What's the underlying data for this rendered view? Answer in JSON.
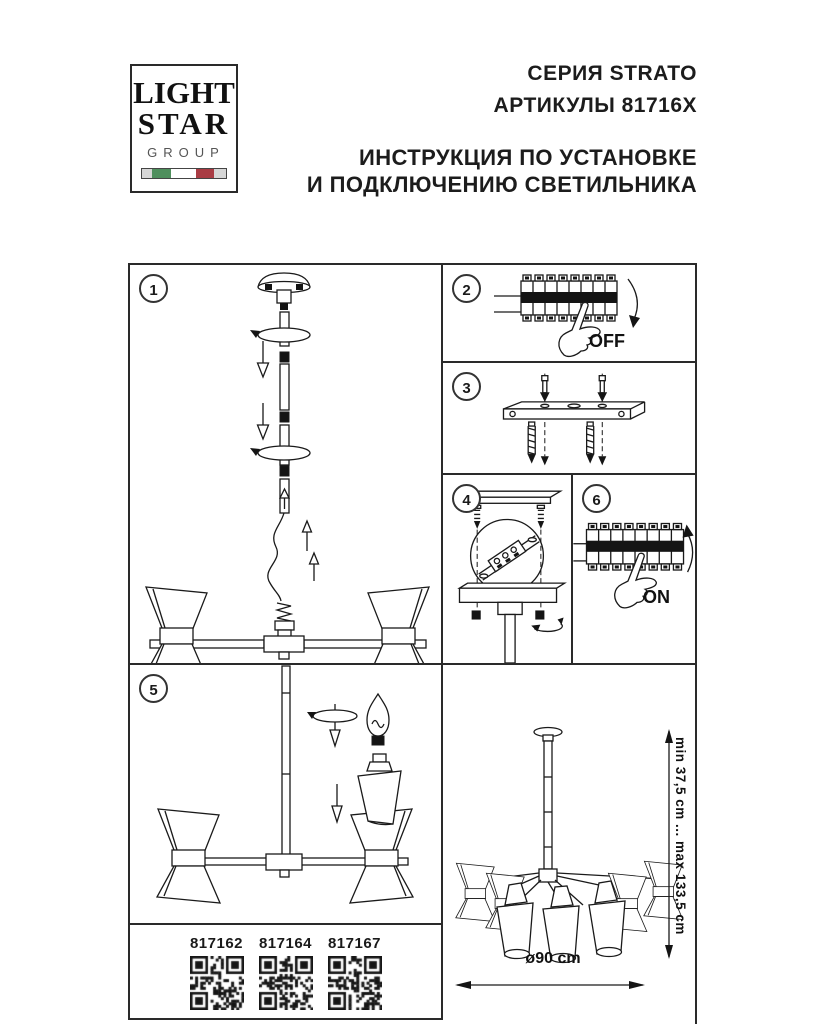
{
  "header": {
    "logo": {
      "line1": "LIGHT",
      "line2": "STAR",
      "line3": "GROUP",
      "flag_colors": [
        "#4f8f5d",
        "#ffffff",
        "#a93c44"
      ]
    },
    "series": "СЕРИЯ STRATO",
    "articles": "АРТИКУЛЫ 81716X",
    "instruction_line1": "ИНСТРУКЦИЯ ПО УСТАНОВКЕ",
    "instruction_line2": "И ПОДКЛЮЧЕНИЮ СВЕТИЛЬНИКА"
  },
  "panels": {
    "step1": {
      "number": "1"
    },
    "step2": {
      "number": "2",
      "label": "OFF"
    },
    "step3": {
      "number": "3"
    },
    "step4": {
      "number": "4"
    },
    "step5": {
      "number": "5"
    },
    "step6": {
      "number": "6",
      "label": "ON"
    }
  },
  "dimensions": {
    "height_range": "min 37,5 cm ... max 133,5 cm",
    "diameter": "ø90 cm"
  },
  "qr_codes": [
    {
      "article": "817162"
    },
    {
      "article": "817164"
    },
    {
      "article": "817167"
    }
  ],
  "colors": {
    "line": "#1a1a1a",
    "flag_green": "#4f8f5d",
    "flag_red": "#a93c44"
  }
}
